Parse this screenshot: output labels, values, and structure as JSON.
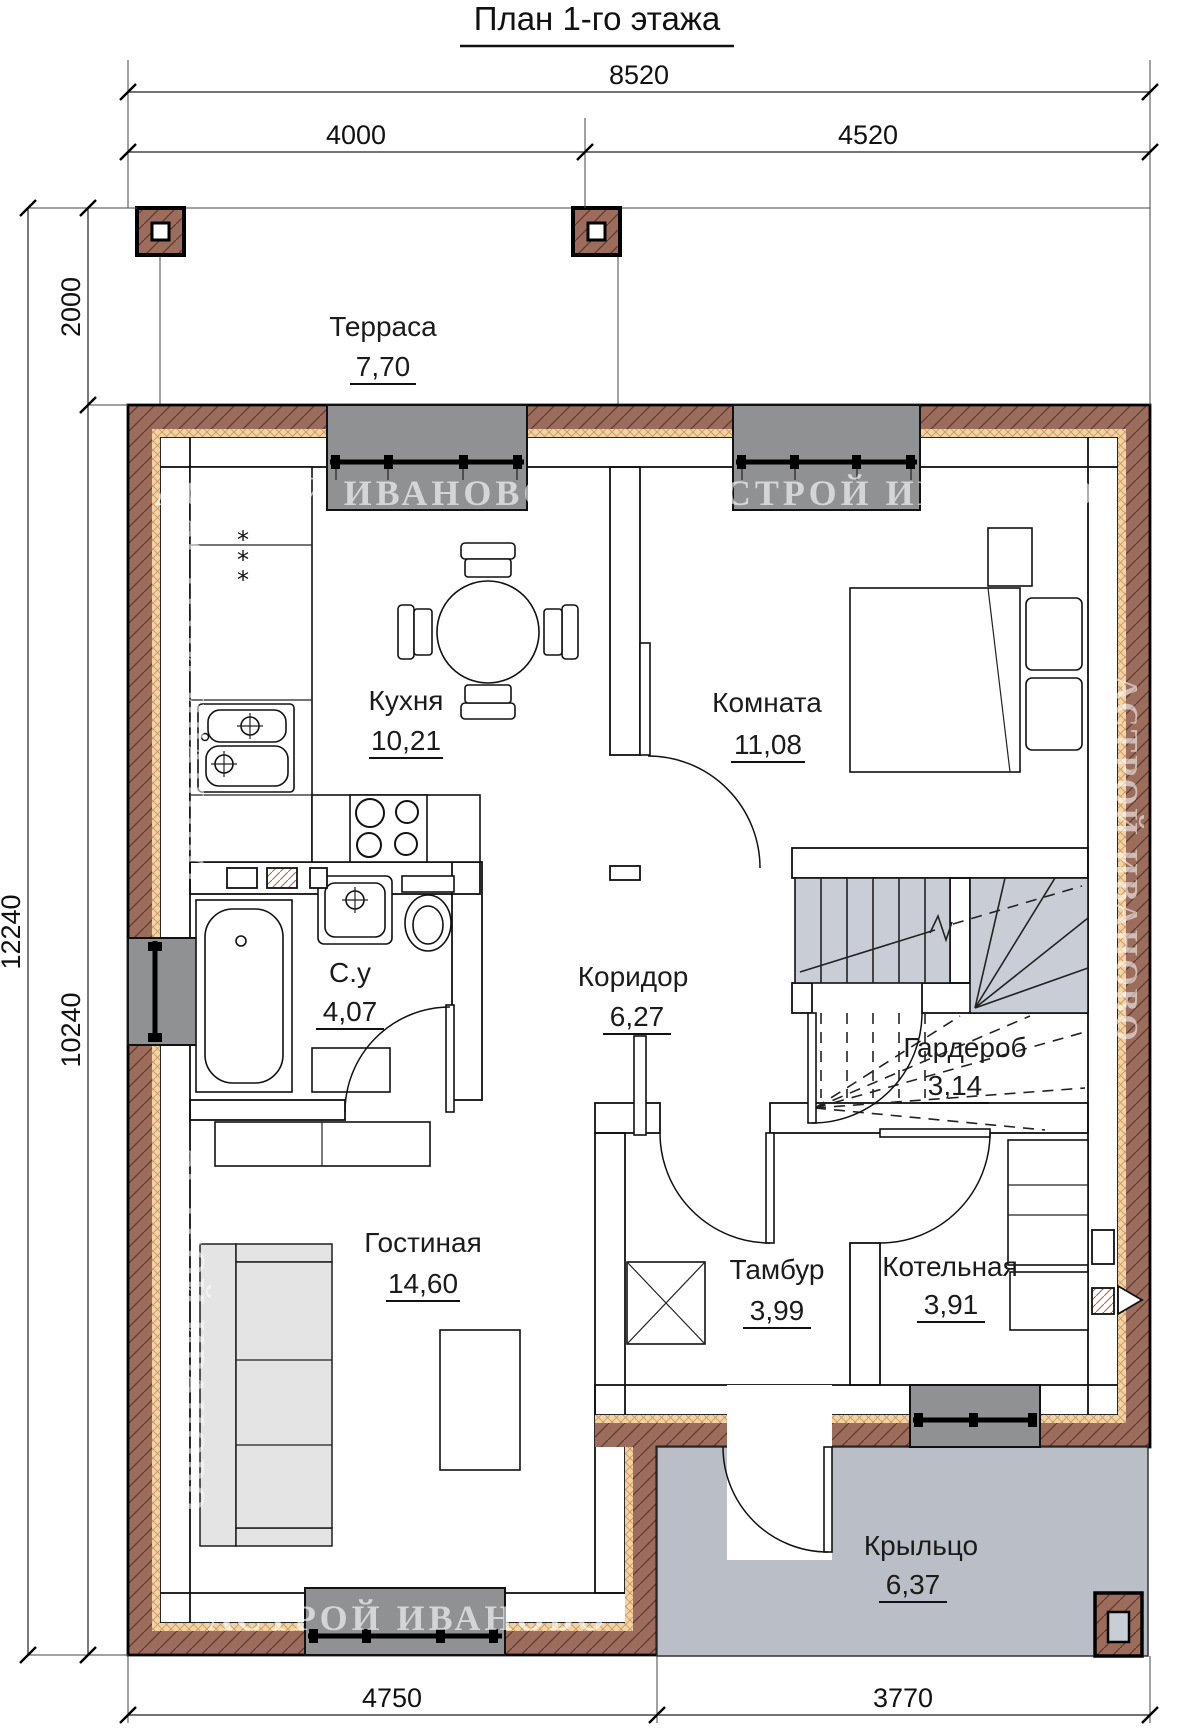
{
  "title": "План 1-го этажа",
  "watermark": "АСТРОЙ ИВАНОВО",
  "rooms": [
    {
      "name": "Терраса",
      "area": "7,70"
    },
    {
      "name": "Кухня",
      "area": "10,21"
    },
    {
      "name": "Комната",
      "area": "11,08"
    },
    {
      "name": "С.у",
      "area": "4,07"
    },
    {
      "name": "Коридор",
      "area": "6,27"
    },
    {
      "name": "Гардероб",
      "area": "3,14"
    },
    {
      "name": "Гостиная",
      "area": "14,60"
    },
    {
      "name": "Тамбур",
      "area": "3,99"
    },
    {
      "name": "Котельная",
      "area": "3,91"
    },
    {
      "name": "Крыльцо",
      "area": "6,37"
    }
  ],
  "dimensions": {
    "overall_width": "8520",
    "width_left": "4000",
    "width_right": "4520",
    "overall_height": "12240",
    "terrace_depth": "2000",
    "house_height": "10240",
    "bottom_left": "4750",
    "bottom_right": "3770"
  },
  "symbols": {
    "vent": "*"
  },
  "colors": {
    "wall_block": "#0E9C6E",
    "wall_block_hatch": "#0A7A55",
    "wall_brick": "#9C6C5D",
    "wall_brick_hatch": "#5F3B31",
    "insulation": "#F3D3A3",
    "window_opening": "#8F9193",
    "porch": "#B9BEC7",
    "stair_tread": "#C9CDD6",
    "watermark_color": "#FFFFFF"
  }
}
